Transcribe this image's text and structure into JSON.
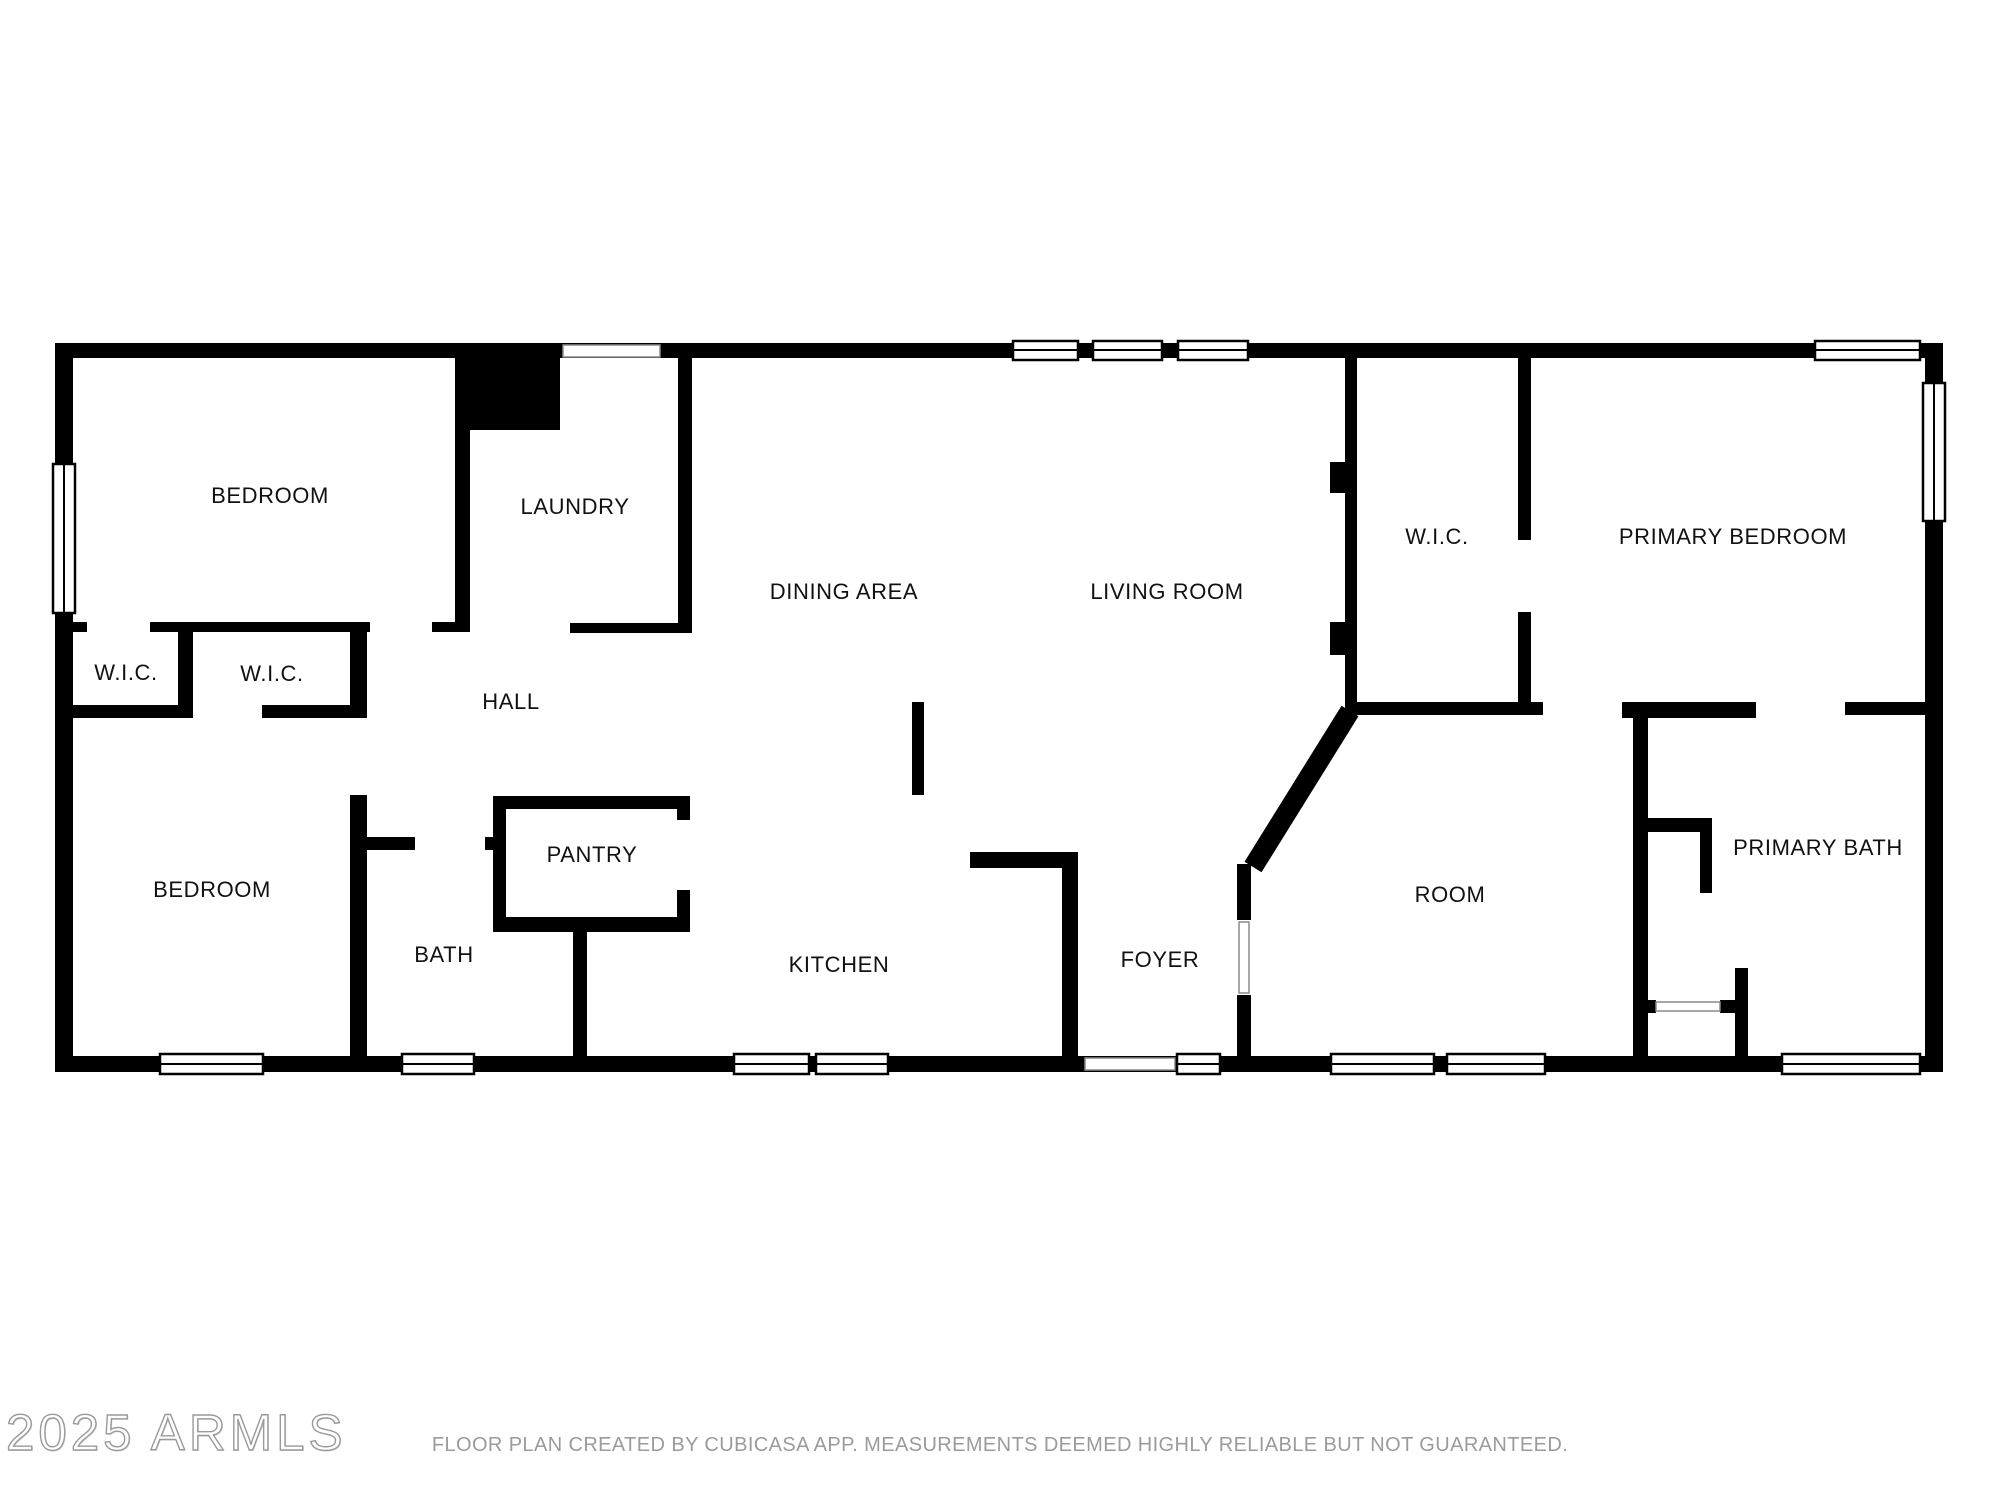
{
  "watermark": {
    "text": "2025 ARMLS"
  },
  "disclaimer": "FLOOR PLAN CREATED BY CUBICASA APP. MEASUREMENTS DEEMED HIGHLY RELIABLE BUT NOT GUARANTEED.",
  "colors": {
    "background": "#ffffff",
    "wall": "#000000",
    "room_label": "#111111",
    "disclaimer_text": "#9b9b9b",
    "watermark_outline": "#9a9a9a"
  },
  "rooms": [
    {
      "id": "bedroom-top-left",
      "label": "BEDROOM"
    },
    {
      "id": "laundry",
      "label": "LAUNDRY"
    },
    {
      "id": "dining-area",
      "label": "DINING AREA"
    },
    {
      "id": "living-room",
      "label": "LIVING ROOM"
    },
    {
      "id": "wic-primary",
      "label": "W.I.C."
    },
    {
      "id": "primary-bedroom",
      "label": "PRIMARY BEDROOM"
    },
    {
      "id": "wic-left-1",
      "label": "W.I.C."
    },
    {
      "id": "wic-left-2",
      "label": "W.I.C."
    },
    {
      "id": "hall",
      "label": "HALL"
    },
    {
      "id": "bedroom-bottom-left",
      "label": "BEDROOM"
    },
    {
      "id": "bath",
      "label": "BATH"
    },
    {
      "id": "pantry",
      "label": "PANTRY"
    },
    {
      "id": "kitchen",
      "label": "KITCHEN"
    },
    {
      "id": "foyer",
      "label": "FOYER"
    },
    {
      "id": "room",
      "label": "ROOM"
    },
    {
      "id": "primary-bath",
      "label": "PRIMARY BATH"
    }
  ]
}
